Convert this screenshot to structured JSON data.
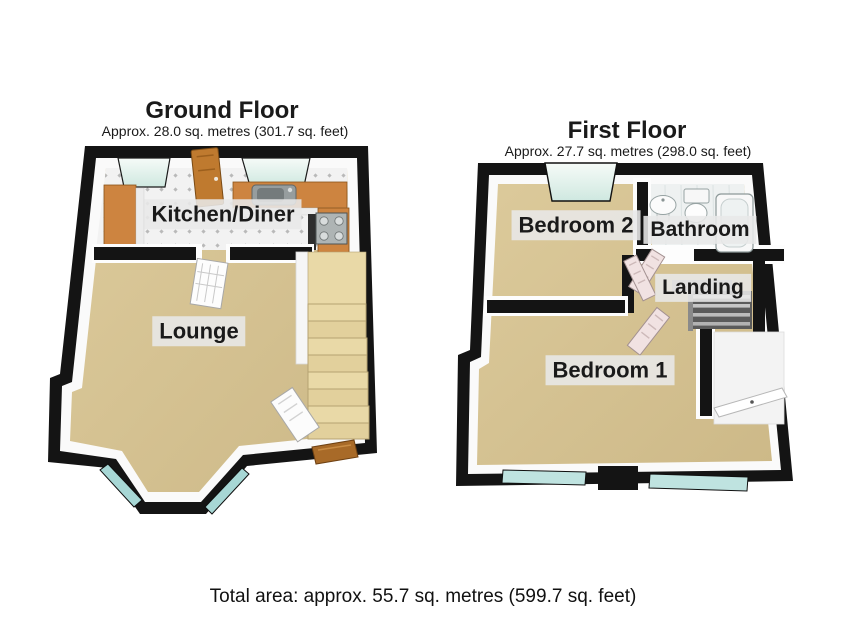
{
  "ground_floor": {
    "title": "Ground Floor",
    "subtitle": "Approx. 28.0 sq. metres (301.7 sq. feet)",
    "rooms": {
      "kitchen_diner": "Kitchen/Diner",
      "lounge": "Lounge"
    }
  },
  "first_floor": {
    "title": "First Floor",
    "subtitle": "Approx. 27.7 sq. metres (298.0 sq. feet)",
    "rooms": {
      "bedroom2": "Bedroom 2",
      "bathroom": "Bathroom",
      "landing": "Landing",
      "bedroom1": "Bedroom 1"
    }
  },
  "footer": {
    "total_area": "Total area: approx. 55.7 sq. metres (599.7 sq. feet)"
  },
  "colors": {
    "background": "#ffffff",
    "wall": "#141414",
    "wall_inner": "#fafafa",
    "carpet": "#d5c393",
    "kitchen_tile": "#f2f2f2",
    "window_glass": "#a7d7d5",
    "glass_pane": "#e7f4ef",
    "wood_counter": "#cd8440",
    "wood_door": "#bf7a2f",
    "front_door_wood": "#a86a28",
    "stairs": "#e9d9a7",
    "interior_door": "#f1e2e2",
    "label_bg": "#e8e8e8",
    "text": "#1a1a1a"
  }
}
